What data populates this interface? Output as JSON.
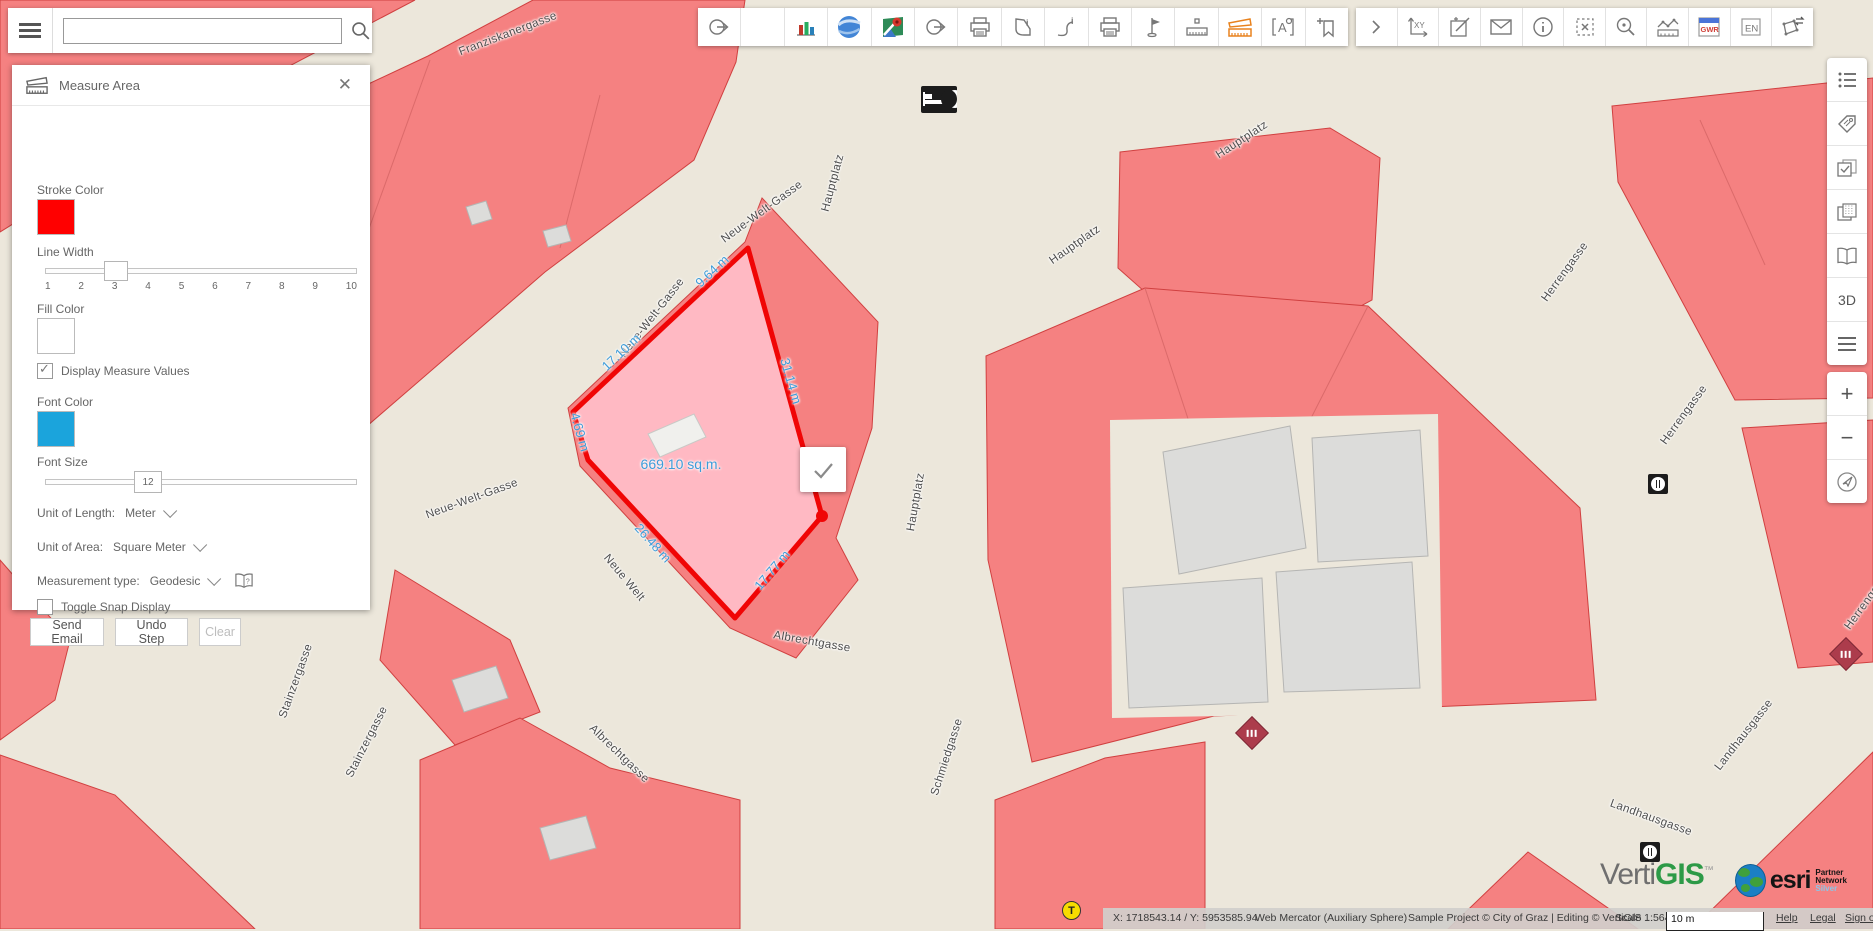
{
  "search": {
    "value": ""
  },
  "toolbar": {
    "gwr_label": "GWR",
    "en_label": "EN"
  },
  "right_toolbar": {
    "threed_label": "3D"
  },
  "panel": {
    "title": "Measure Area",
    "stroke_color_label": "Stroke Color",
    "stroke_color": "#FF0000",
    "line_width_label": "Line Width",
    "line_width_value": 3,
    "line_width_ticks": [
      "1",
      "2",
      "3",
      "4",
      "5",
      "6",
      "7",
      "8",
      "9",
      "10"
    ],
    "fill_color_label": "Fill Color",
    "fill_color": "#FFFFFF",
    "display_measure_values_label": "Display Measure Values",
    "display_measure_values_checked": true,
    "font_color_label": "Font Color",
    "font_color": "#1BA4DC",
    "font_size_label": "Font Size",
    "font_size_value": "12",
    "unit_of_length_label": "Unit of Length:",
    "unit_of_length_value": "Meter",
    "unit_of_area_label": "Unit of Area:",
    "unit_of_area_value": "Square Meter",
    "measurement_type_label": "Measurement type:",
    "measurement_type_value": "Geodesic",
    "toggle_snap_label": "Toggle Snap Display",
    "toggle_snap_checked": false,
    "buttons": {
      "send_email": "Send Email",
      "undo_step": "Undo Step",
      "clear": "Clear"
    }
  },
  "map": {
    "street_labels": [
      {
        "text": "Franziskanergasse",
        "x": 508,
        "y": 34,
        "rot": -21
      },
      {
        "text": "Neue-Welt-Gasse",
        "x": 762,
        "y": 212,
        "rot": -36
      },
      {
        "text": "Neue-Welt-Gasse",
        "x": 652,
        "y": 318,
        "rot": -52
      },
      {
        "text": "Neue-Welt-Gasse",
        "x": 472,
        "y": 499,
        "rot": -20
      },
      {
        "text": "Neue Welt",
        "x": 624,
        "y": 578,
        "rot": 50
      },
      {
        "text": "Hauptplatz",
        "x": 833,
        "y": 183,
        "rot": -75
      },
      {
        "text": "Hauptplatz",
        "x": 1075,
        "y": 245,
        "rot": -35
      },
      {
        "text": "Hauptplatz",
        "x": 1242,
        "y": 140,
        "rot": -33
      },
      {
        "text": "Hauptplatz",
        "x": 916,
        "y": 502,
        "rot": -80
      },
      {
        "text": "Herrengasse",
        "x": 1565,
        "y": 272,
        "rot": -54
      },
      {
        "text": "Herrengasse",
        "x": 1684,
        "y": 415,
        "rot": -54
      },
      {
        "text": "Herrengasse",
        "x": 1868,
        "y": 600,
        "rot": -54
      },
      {
        "text": "Albrechtgasse",
        "x": 812,
        "y": 642,
        "rot": 10
      },
      {
        "text": "Albrechtgasse",
        "x": 619,
        "y": 754,
        "rot": 44
      },
      {
        "text": "Schmiedgasse",
        "x": 947,
        "y": 757,
        "rot": -72
      },
      {
        "text": "Stainzergasse",
        "x": 296,
        "y": 681,
        "rot": -70
      },
      {
        "text": "Stainzergasse",
        "x": 367,
        "y": 742,
        "rot": -63
      },
      {
        "text": "Landhausgasse",
        "x": 1744,
        "y": 735,
        "rot": -52
      },
      {
        "text": "Landhausgasse",
        "x": 1651,
        "y": 818,
        "rot": 20
      }
    ],
    "measure_labels": [
      {
        "text": "9.64 m",
        "x": 712,
        "y": 271,
        "rot": -43,
        "size": 13
      },
      {
        "text": "17.10 m",
        "x": 621,
        "y": 352,
        "rot": -43,
        "size": 13
      },
      {
        "text": "4.69 m",
        "x": 580,
        "y": 432,
        "rot": 74,
        "size": 13
      },
      {
        "text": "26.48 m",
        "x": 653,
        "y": 543,
        "rot": 48,
        "size": 13
      },
      {
        "text": "17.77 m",
        "x": 772,
        "y": 570,
        "rot": -50,
        "size": 13
      },
      {
        "text": "31.14 m",
        "x": 791,
        "y": 381,
        "rot": 74,
        "size": 13
      },
      {
        "text": "669.10 sq.m.",
        "x": 681,
        "y": 464,
        "rot": 0,
        "size": 14
      }
    ],
    "transit_label": "T"
  },
  "statusbar": {
    "coordinates": "X: 1718543.14 / Y: 5953585.94",
    "projection": "Web Mercator (Auxiliary Sphere)",
    "attribution": "Sample Project © City of Graz | Editing © VertiGIS ...",
    "scale": "Scale 1:564",
    "scalebar_label": "10 m",
    "links": {
      "help": "Help",
      "legal": "Legal",
      "sign_out": "Sign out"
    }
  },
  "branding": {
    "vertigis_prefix": "Verti",
    "vertigis_suffix": "GIS",
    "vertigis_tm": "™",
    "esri_text": "esri",
    "esri_partner": "Partner Network",
    "esri_tier": "Silver"
  }
}
